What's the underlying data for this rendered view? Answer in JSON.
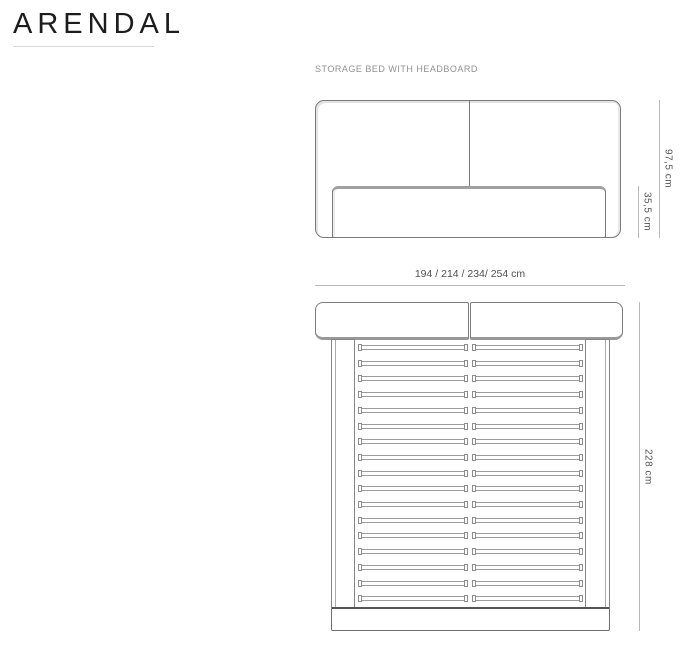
{
  "brand": {
    "title": "ARENDAL"
  },
  "product": {
    "label": "STORAGE BED WITH HEADBOARD"
  },
  "diagram": {
    "type": "furniture-spec-drawing",
    "front_view": {
      "description": "front elevation of storage bed with two-panel headboard and bed base",
      "height_total": "97,5 cm",
      "height_base": "35,5 cm"
    },
    "top_view": {
      "description": "plan view of bed frame with headboard, side rails, split slats and footboard",
      "width_options": "194 / 214 / 234/ 254 cm",
      "length": "228 cm",
      "slat_rows": 17,
      "slat_columns": 2
    },
    "colors": {
      "line": "#7b7b7b",
      "dim_line": "#b9b9b9",
      "dim_text": "#555555",
      "shadow": "#989898",
      "brand": "#1c1c1c",
      "muted_text": "#909090"
    }
  }
}
